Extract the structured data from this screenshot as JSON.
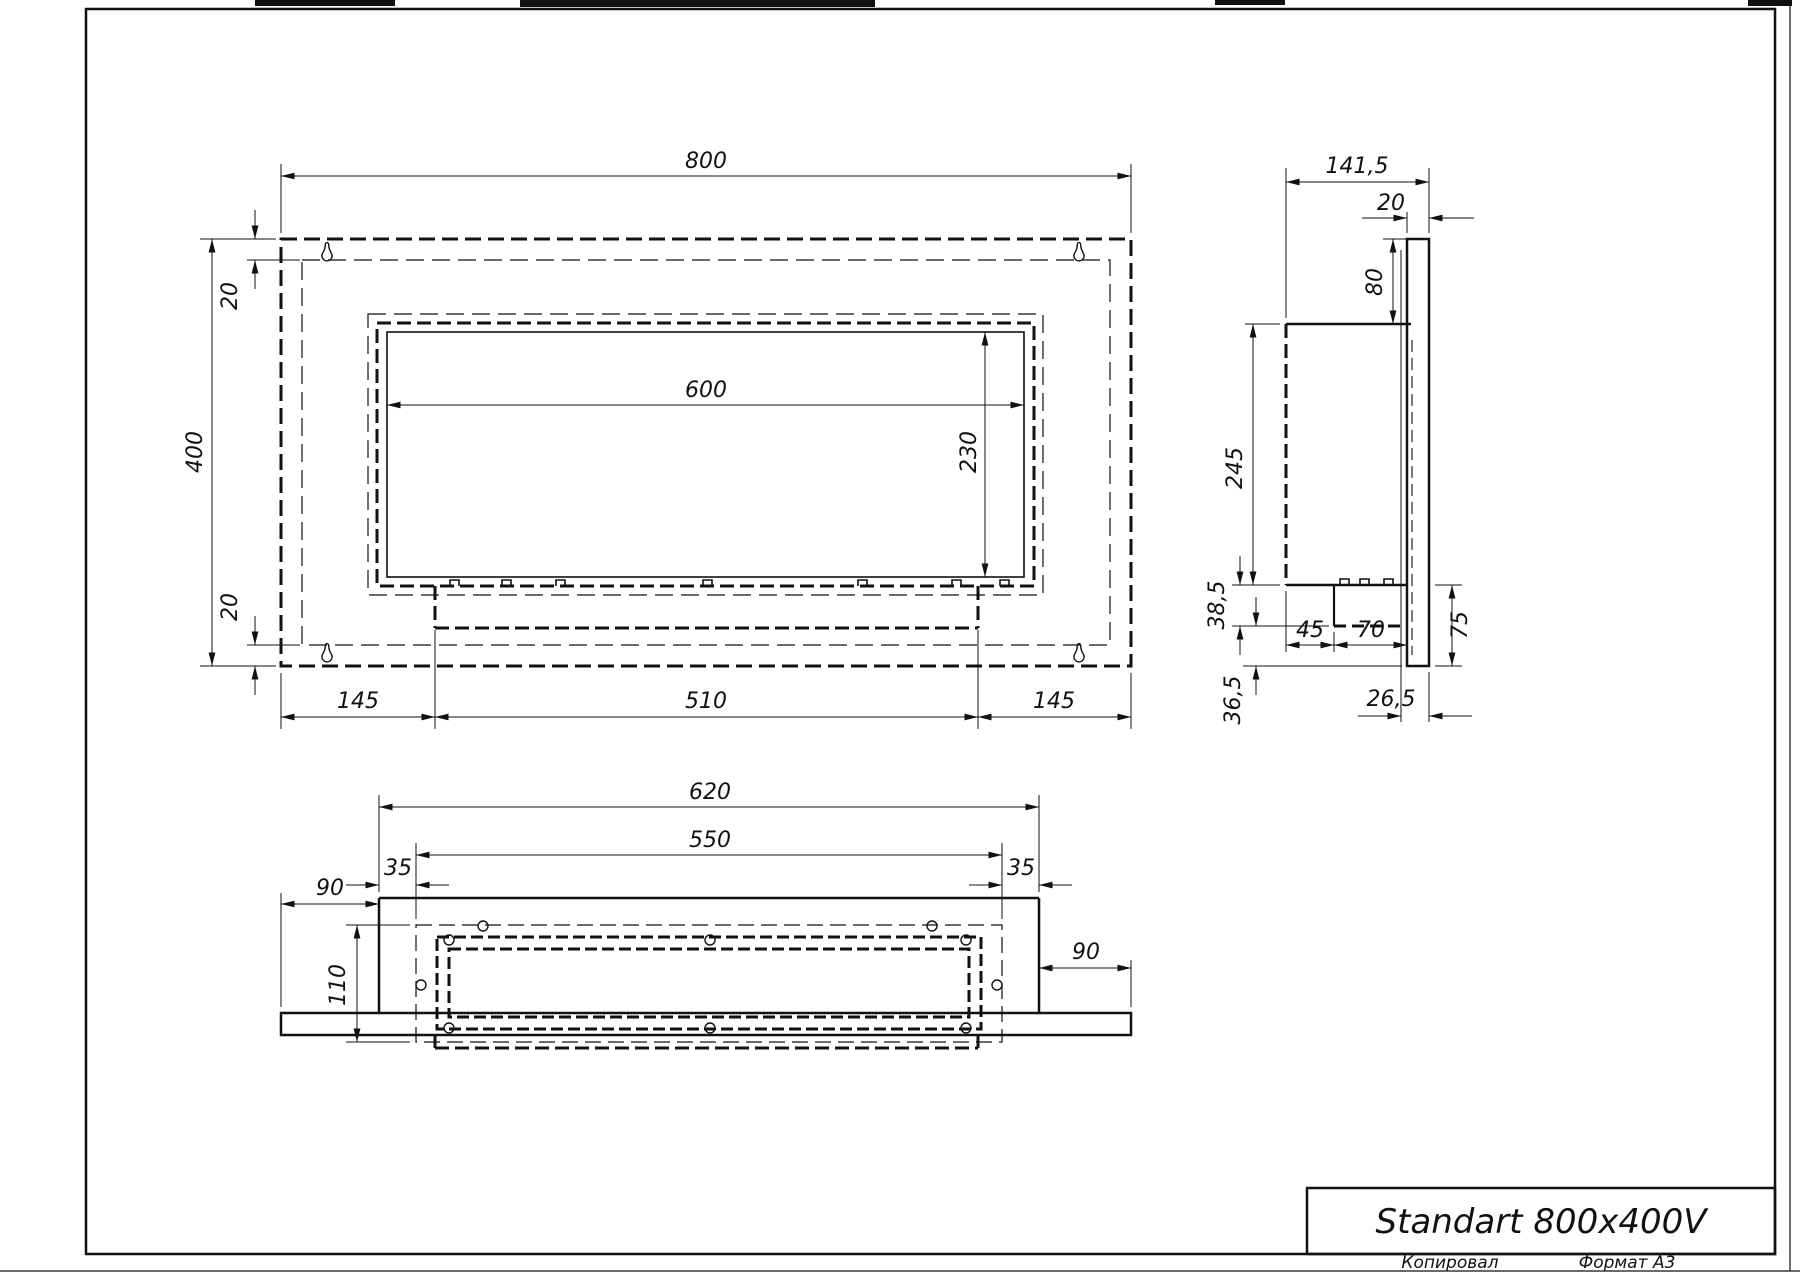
{
  "drawing": {
    "title": "Standart 800x400V",
    "stamp_copied": "Копировал",
    "stamp_format": "Формат А3"
  },
  "front_view": {
    "width": "800",
    "height": "400",
    "top_margin": "20",
    "bottom_margin": "20",
    "opening_width": "600",
    "opening_height": "230",
    "left_margin": "145",
    "burner_width": "510",
    "right_margin": "145"
  },
  "side_view": {
    "depth": "141,5",
    "back_plate_thickness": "20",
    "top_offset": "80",
    "body_height": "245",
    "tray_height": "38,5",
    "tray_offset": "45",
    "tray_depth": "70",
    "bottom_flange": "75",
    "back_offset": "26,5",
    "bottom_offset": "36,5"
  },
  "bottom_view": {
    "body_width": "620",
    "opening_width": "550",
    "left_margin": "35",
    "right_margin": "35",
    "left_flange": "90",
    "opening_depth": "110",
    "right_flange": "90"
  }
}
